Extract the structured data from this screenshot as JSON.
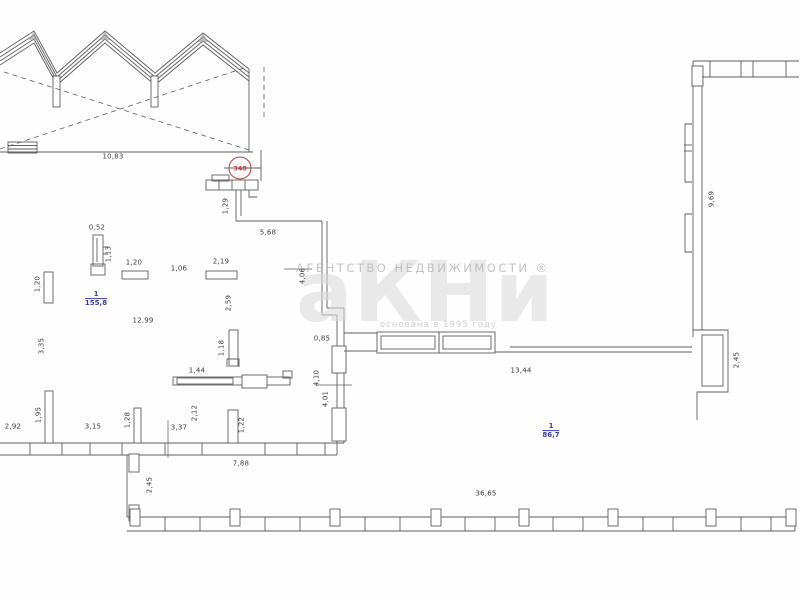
{
  "title": "Floor plan scan",
  "colors": {
    "line": "#5f5f5f",
    "dimension_text": "#3c3c3c",
    "room_label_blue": "#3c3cae",
    "revision_red": "#b84040",
    "watermark_gray": "#c9c9c9"
  },
  "revision_mark": {
    "value": "348"
  },
  "watermark": {
    "agency_text": "АГЕНТСТВО  НЕДВИЖИМОСТИ ®",
    "logo_text": "аКНи",
    "subtext": "основана в 1995 году"
  },
  "rooms": [
    {
      "number": "1",
      "area": "155,8"
    },
    {
      "number": "1",
      "area": "86,7"
    }
  ],
  "dimensions": [
    {
      "text": "10,83"
    },
    {
      "text": "1,29"
    },
    {
      "text": "5,68"
    },
    {
      "text": "0,52"
    },
    {
      "text": "1,13"
    },
    {
      "text": "1,20"
    },
    {
      "text": "1,06"
    },
    {
      "text": "2,19"
    },
    {
      "text": "1,20"
    },
    {
      "text": "12,99"
    },
    {
      "text": "3,35"
    },
    {
      "text": "2,59"
    },
    {
      "text": "1,18"
    },
    {
      "text": "1,44"
    },
    {
      "text": "0,85"
    },
    {
      "text": "4,06"
    },
    {
      "text": "4,10"
    },
    {
      "text": "4,01"
    },
    {
      "text": "2,12"
    },
    {
      "text": "3,37"
    },
    {
      "text": "1,22"
    },
    {
      "text": "1,95"
    },
    {
      "text": "2,92"
    },
    {
      "text": "3,15"
    },
    {
      "text": "1,28"
    },
    {
      "text": "7,88"
    },
    {
      "text": "2,45"
    },
    {
      "text": "13,44"
    },
    {
      "text": "36,65"
    },
    {
      "text": "9,69"
    },
    {
      "text": "2,45"
    }
  ]
}
